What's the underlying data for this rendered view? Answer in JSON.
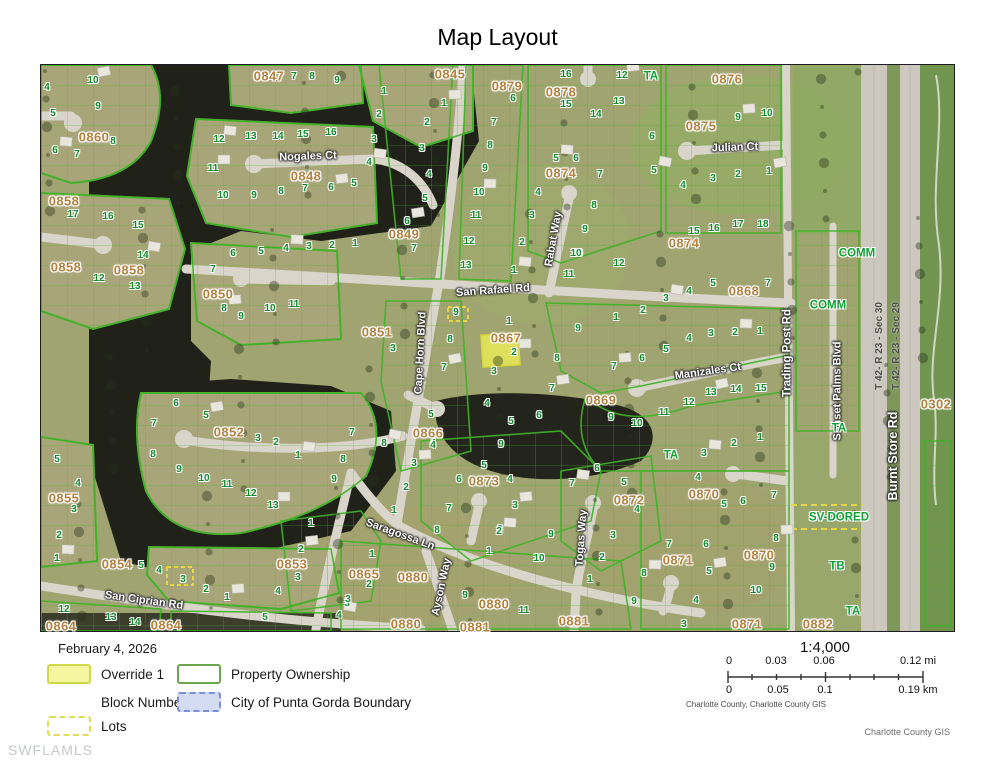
{
  "title": "Map Layout",
  "legend": {
    "date": "February 4, 2026",
    "items": [
      {
        "label": "Override 1",
        "swatch": "override"
      },
      {
        "label": "Block Number",
        "swatch": "none"
      },
      {
        "label": "Lots",
        "swatch": "lots"
      },
      {
        "label": "Property Ownership",
        "swatch": "ownership"
      },
      {
        "label": "City of Punta Gorda Boundary",
        "swatch": "city-boundary"
      }
    ]
  },
  "scale": {
    "ratio": "1:4,000",
    "mi_labels": [
      "0",
      "0.03",
      "0.06",
      "0.12 mi"
    ],
    "km_labels": [
      "0",
      "0.05",
      "0.1",
      "0.19 km"
    ],
    "attribution": "Charlotte County, Charlotte County GIS"
  },
  "footer": {
    "watermark": "SWFLAMLS",
    "credit": "Charlotte County GIS"
  },
  "colors": {
    "highlight_parcel": "#e9ea56",
    "parcel_outline": "#3fb327",
    "block_label": "#b5813f",
    "lot_label": "#138a30",
    "zone_label": "#0ea233",
    "water": "#20221a",
    "road": "#d9d5cb"
  },
  "map": {
    "highlight": {
      "block": "0867",
      "lot": "2"
    },
    "streets": [
      {
        "t": "Nogales Ct",
        "x": 307,
        "y": 156,
        "r": -2
      },
      {
        "t": "San Rafael Rd",
        "x": 492,
        "y": 290,
        "r": -4
      },
      {
        "t": "Rabat Way",
        "x": 553,
        "y": 238,
        "r": -80
      },
      {
        "t": "Julian Ct",
        "x": 734,
        "y": 147,
        "r": -2
      },
      {
        "t": "Cape Horn Blvd",
        "x": 420,
        "y": 352,
        "r": -87
      },
      {
        "t": "Manizales Ct",
        "x": 707,
        "y": 371,
        "r": -8
      },
      {
        "t": "Trading Post Rd",
        "x": 787,
        "y": 352,
        "r": -90,
        "s": 11.5
      },
      {
        "t": "Sunset Palms Blvd",
        "x": 837,
        "y": 390,
        "r": -90
      },
      {
        "t": "Burnt Store Rd",
        "x": 892,
        "y": 455,
        "r": -90,
        "s": 12.5
      },
      {
        "t": "Saragossa Ln",
        "x": 399,
        "y": 534,
        "r": 20
      },
      {
        "t": "Ayson Way",
        "x": 441,
        "y": 586,
        "r": -78
      },
      {
        "t": "Togas Way",
        "x": 581,
        "y": 537,
        "r": -86
      },
      {
        "t": "San Ciprian Rd",
        "x": 143,
        "y": 600,
        "r": 8
      }
    ],
    "sections": [
      {
        "t": "T 42- R 23 - Sec 30",
        "x": 879,
        "y": 345,
        "r": -90
      },
      {
        "t": "T 42- R 23 - Sec 29",
        "x": 896,
        "y": 345,
        "r": -90
      }
    ],
    "zones": [
      {
        "t": "TA",
        "x": 650,
        "y": 76
      },
      {
        "t": "COMM",
        "x": 856,
        "y": 253
      },
      {
        "t": "COMM",
        "x": 827,
        "y": 305
      },
      {
        "t": "TA",
        "x": 838,
        "y": 428
      },
      {
        "t": "TA",
        "x": 670,
        "y": 455
      },
      {
        "t": "SV-DORED",
        "x": 838,
        "y": 517
      },
      {
        "t": "TB",
        "x": 836,
        "y": 566
      },
      {
        "t": "TA",
        "x": 852,
        "y": 611
      }
    ],
    "blocks": [
      {
        "t": "0847",
        "x": 268,
        "y": 75
      },
      {
        "t": "0845",
        "x": 449,
        "y": 73
      },
      {
        "t": "0879",
        "x": 506,
        "y": 85
      },
      {
        "t": "0878",
        "x": 560,
        "y": 91
      },
      {
        "t": "0876",
        "x": 726,
        "y": 78
      },
      {
        "t": "0875",
        "x": 700,
        "y": 125
      },
      {
        "t": "0860",
        "x": 93,
        "y": 136
      },
      {
        "t": "0848",
        "x": 305,
        "y": 175
      },
      {
        "t": "0874",
        "x": 560,
        "y": 172
      },
      {
        "t": "0874",
        "x": 683,
        "y": 242
      },
      {
        "t": "0858",
        "x": 63,
        "y": 200
      },
      {
        "t": "0858",
        "x": 65,
        "y": 266
      },
      {
        "t": "0858",
        "x": 128,
        "y": 269
      },
      {
        "t": "0850",
        "x": 217,
        "y": 293
      },
      {
        "t": "0849",
        "x": 403,
        "y": 233
      },
      {
        "t": "0851",
        "x": 376,
        "y": 331
      },
      {
        "t": "0867",
        "x": 505,
        "y": 337
      },
      {
        "t": "0866",
        "x": 427,
        "y": 432
      },
      {
        "t": "0869",
        "x": 600,
        "y": 399
      },
      {
        "t": "0868",
        "x": 743,
        "y": 290
      },
      {
        "t": "0852",
        "x": 228,
        "y": 431
      },
      {
        "t": "0855",
        "x": 63,
        "y": 497
      },
      {
        "t": "0854",
        "x": 116,
        "y": 563
      },
      {
        "t": "0853",
        "x": 291,
        "y": 563
      },
      {
        "t": "0864",
        "x": 60,
        "y": 625
      },
      {
        "t": "0864",
        "x": 165,
        "y": 624
      },
      {
        "t": "0865",
        "x": 363,
        "y": 573
      },
      {
        "t": "0873",
        "x": 483,
        "y": 480
      },
      {
        "t": "0872",
        "x": 628,
        "y": 499
      },
      {
        "t": "0880",
        "x": 412,
        "y": 576
      },
      {
        "t": "0880",
        "x": 493,
        "y": 603
      },
      {
        "t": "0880",
        "x": 405,
        "y": 623
      },
      {
        "t": "0881",
        "x": 474,
        "y": 626
      },
      {
        "t": "0881",
        "x": 573,
        "y": 620
      },
      {
        "t": "0870",
        "x": 703,
        "y": 493
      },
      {
        "t": "0870",
        "x": 758,
        "y": 554
      },
      {
        "t": "0871",
        "x": 677,
        "y": 559
      },
      {
        "t": "0871",
        "x": 746,
        "y": 623
      },
      {
        "t": "0882",
        "x": 817,
        "y": 623
      },
      {
        "t": "0302",
        "x": 935,
        "y": 403
      }
    ],
    "lots": [
      [
        92,
        80,
        "10"
      ],
      [
        46,
        87,
        "4"
      ],
      [
        97,
        106,
        "9"
      ],
      [
        52,
        113,
        "5"
      ],
      [
        112,
        141,
        "8"
      ],
      [
        54,
        150,
        "6"
      ],
      [
        76,
        154,
        "7"
      ],
      [
        293,
        76,
        "7"
      ],
      [
        311,
        76,
        "8"
      ],
      [
        336,
        80,
        "9"
      ],
      [
        443,
        103,
        "1"
      ],
      [
        426,
        122,
        "2"
      ],
      [
        421,
        148,
        "3"
      ],
      [
        428,
        174,
        "4"
      ],
      [
        424,
        198,
        "5"
      ],
      [
        406,
        221,
        "6"
      ],
      [
        413,
        248,
        "7"
      ],
      [
        383,
        91,
        "1"
      ],
      [
        378,
        114,
        "2"
      ],
      [
        373,
        139,
        "3"
      ],
      [
        368,
        162,
        "4"
      ],
      [
        512,
        98,
        "6"
      ],
      [
        493,
        122,
        "7"
      ],
      [
        489,
        145,
        "8"
      ],
      [
        484,
        168,
        "9"
      ],
      [
        478,
        192,
        "10"
      ],
      [
        475,
        215,
        "11"
      ],
      [
        468,
        241,
        "12"
      ],
      [
        465,
        265,
        "13"
      ],
      [
        565,
        74,
        "16"
      ],
      [
        621,
        75,
        "12"
      ],
      [
        565,
        104,
        "15"
      ],
      [
        595,
        114,
        "14"
      ],
      [
        618,
        101,
        "13"
      ],
      [
        651,
        136,
        "6"
      ],
      [
        653,
        170,
        "5"
      ],
      [
        599,
        174,
        "7"
      ],
      [
        593,
        205,
        "8"
      ],
      [
        584,
        229,
        "9"
      ],
      [
        576,
        253,
        "10"
      ],
      [
        555,
        158,
        "5"
      ],
      [
        575,
        158,
        "6"
      ],
      [
        537,
        192,
        "4"
      ],
      [
        531,
        215,
        "3"
      ],
      [
        521,
        242,
        "2"
      ],
      [
        737,
        117,
        "9"
      ],
      [
        766,
        113,
        "10"
      ],
      [
        682,
        185,
        "4"
      ],
      [
        712,
        178,
        "3"
      ],
      [
        737,
        174,
        "2"
      ],
      [
        768,
        171,
        "1"
      ],
      [
        693,
        231,
        "15"
      ],
      [
        713,
        228,
        "16"
      ],
      [
        737,
        224,
        "17"
      ],
      [
        762,
        224,
        "18"
      ],
      [
        218,
        139,
        "12"
      ],
      [
        250,
        136,
        "13"
      ],
      [
        277,
        136,
        "14"
      ],
      [
        302,
        134,
        "15"
      ],
      [
        330,
        132,
        "16"
      ],
      [
        212,
        168,
        "11"
      ],
      [
        222,
        195,
        "10"
      ],
      [
        253,
        195,
        "9"
      ],
      [
        280,
        191,
        "8"
      ],
      [
        304,
        188,
        "7"
      ],
      [
        330,
        187,
        "6"
      ],
      [
        353,
        183,
        "5"
      ],
      [
        72,
        214,
        "17"
      ],
      [
        107,
        216,
        "16"
      ],
      [
        137,
        225,
        "15"
      ],
      [
        142,
        255,
        "14"
      ],
      [
        98,
        278,
        "12"
      ],
      [
        134,
        286,
        "13"
      ],
      [
        232,
        253,
        "6"
      ],
      [
        260,
        251,
        "5"
      ],
      [
        285,
        248,
        "4"
      ],
      [
        308,
        246,
        "3"
      ],
      [
        331,
        245,
        "2"
      ],
      [
        354,
        243,
        "1"
      ],
      [
        212,
        269,
        "7"
      ],
      [
        223,
        308,
        "8"
      ],
      [
        240,
        316,
        "9"
      ],
      [
        269,
        308,
        "10"
      ],
      [
        293,
        304,
        "11"
      ],
      [
        392,
        348,
        "3"
      ],
      [
        443,
        367,
        "7"
      ],
      [
        430,
        414,
        "5"
      ],
      [
        432,
        443,
        "4"
      ],
      [
        455,
        312,
        "9"
      ],
      [
        449,
        339,
        "8"
      ],
      [
        513,
        270,
        "1"
      ],
      [
        575,
        253,
        "10"
      ],
      [
        618,
        263,
        "12"
      ],
      [
        568,
        274,
        "11"
      ],
      [
        508,
        321,
        "1"
      ],
      [
        513,
        352,
        "2"
      ],
      [
        493,
        371,
        "3"
      ],
      [
        486,
        403,
        "4"
      ],
      [
        510,
        421,
        "5"
      ],
      [
        538,
        415,
        "6"
      ],
      [
        551,
        388,
        "7"
      ],
      [
        556,
        358,
        "8"
      ],
      [
        577,
        328,
        "9"
      ],
      [
        615,
        317,
        "1"
      ],
      [
        642,
        310,
        "2"
      ],
      [
        665,
        298,
        "3"
      ],
      [
        688,
        291,
        "4"
      ],
      [
        712,
        283,
        "5"
      ],
      [
        767,
        283,
        "7"
      ],
      [
        759,
        331,
        "1"
      ],
      [
        734,
        332,
        "2"
      ],
      [
        710,
        333,
        "3"
      ],
      [
        688,
        338,
        "4"
      ],
      [
        665,
        349,
        "5"
      ],
      [
        641,
        358,
        "6"
      ],
      [
        613,
        366,
        "7"
      ],
      [
        610,
        417,
        "9"
      ],
      [
        636,
        423,
        "10"
      ],
      [
        663,
        412,
        "11"
      ],
      [
        688,
        402,
        "12"
      ],
      [
        710,
        392,
        "13"
      ],
      [
        735,
        389,
        "14"
      ],
      [
        760,
        388,
        "15"
      ],
      [
        759,
        437,
        "1"
      ],
      [
        733,
        443,
        "2"
      ],
      [
        703,
        453,
        "3"
      ],
      [
        697,
        477,
        "4"
      ],
      [
        723,
        504,
        "5"
      ],
      [
        742,
        501,
        "6"
      ],
      [
        773,
        495,
        "7"
      ],
      [
        775,
        538,
        "8"
      ],
      [
        771,
        567,
        "9"
      ],
      [
        755,
        590,
        "10"
      ],
      [
        668,
        544,
        "7"
      ],
      [
        705,
        544,
        "6"
      ],
      [
        708,
        571,
        "5"
      ],
      [
        695,
        600,
        "4"
      ],
      [
        683,
        624,
        "3"
      ],
      [
        596,
        468,
        "6"
      ],
      [
        623,
        482,
        "5"
      ],
      [
        571,
        483,
        "7"
      ],
      [
        636,
        509,
        "4"
      ],
      [
        612,
        535,
        "3"
      ],
      [
        601,
        557,
        "2"
      ],
      [
        589,
        579,
        "1"
      ],
      [
        643,
        573,
        "8"
      ],
      [
        633,
        601,
        "9"
      ],
      [
        483,
        465,
        "5"
      ],
      [
        509,
        479,
        "4"
      ],
      [
        458,
        479,
        "6"
      ],
      [
        514,
        505,
        "3"
      ],
      [
        499,
        529,
        "2"
      ],
      [
        488,
        551,
        "1"
      ],
      [
        448,
        508,
        "7"
      ],
      [
        436,
        530,
        "8"
      ],
      [
        383,
        443,
        "8"
      ],
      [
        432,
        445,
        "4"
      ],
      [
        500,
        444,
        "9"
      ],
      [
        538,
        558,
        "10"
      ],
      [
        550,
        534,
        "9"
      ],
      [
        498,
        531,
        "2"
      ],
      [
        523,
        610,
        "11"
      ],
      [
        464,
        595,
        "9"
      ],
      [
        393,
        510,
        "1"
      ],
      [
        405,
        487,
        "2"
      ],
      [
        413,
        463,
        "3"
      ],
      [
        371,
        554,
        "1"
      ],
      [
        368,
        584,
        "2"
      ],
      [
        346,
        603,
        "3"
      ],
      [
        175,
        403,
        "6"
      ],
      [
        205,
        415,
        "5"
      ],
      [
        153,
        423,
        "7"
      ],
      [
        257,
        438,
        "3"
      ],
      [
        275,
        442,
        "2"
      ],
      [
        152,
        454,
        "8"
      ],
      [
        297,
        455,
        "1"
      ],
      [
        178,
        469,
        "9"
      ],
      [
        203,
        478,
        "10"
      ],
      [
        226,
        484,
        "11"
      ],
      [
        250,
        493,
        "12"
      ],
      [
        272,
        505,
        "13"
      ],
      [
        351,
        432,
        "7"
      ],
      [
        342,
        459,
        "8"
      ],
      [
        333,
        479,
        "9"
      ],
      [
        310,
        523,
        "1"
      ],
      [
        300,
        549,
        "2"
      ],
      [
        297,
        577,
        "3"
      ],
      [
        277,
        591,
        "4"
      ],
      [
        264,
        617,
        "5"
      ],
      [
        347,
        599,
        "3"
      ],
      [
        338,
        615,
        "4"
      ],
      [
        56,
        459,
        "5"
      ],
      [
        77,
        483,
        "4"
      ],
      [
        73,
        509,
        "3"
      ],
      [
        58,
        535,
        "2"
      ],
      [
        56,
        558,
        "1"
      ],
      [
        140,
        565,
        "5"
      ],
      [
        158,
        570,
        "4"
      ],
      [
        182,
        579,
        "3"
      ],
      [
        205,
        589,
        "2"
      ],
      [
        226,
        597,
        "1"
      ],
      [
        63,
        609,
        "12"
      ],
      [
        110,
        617,
        "13"
      ],
      [
        134,
        622,
        "14"
      ]
    ]
  }
}
